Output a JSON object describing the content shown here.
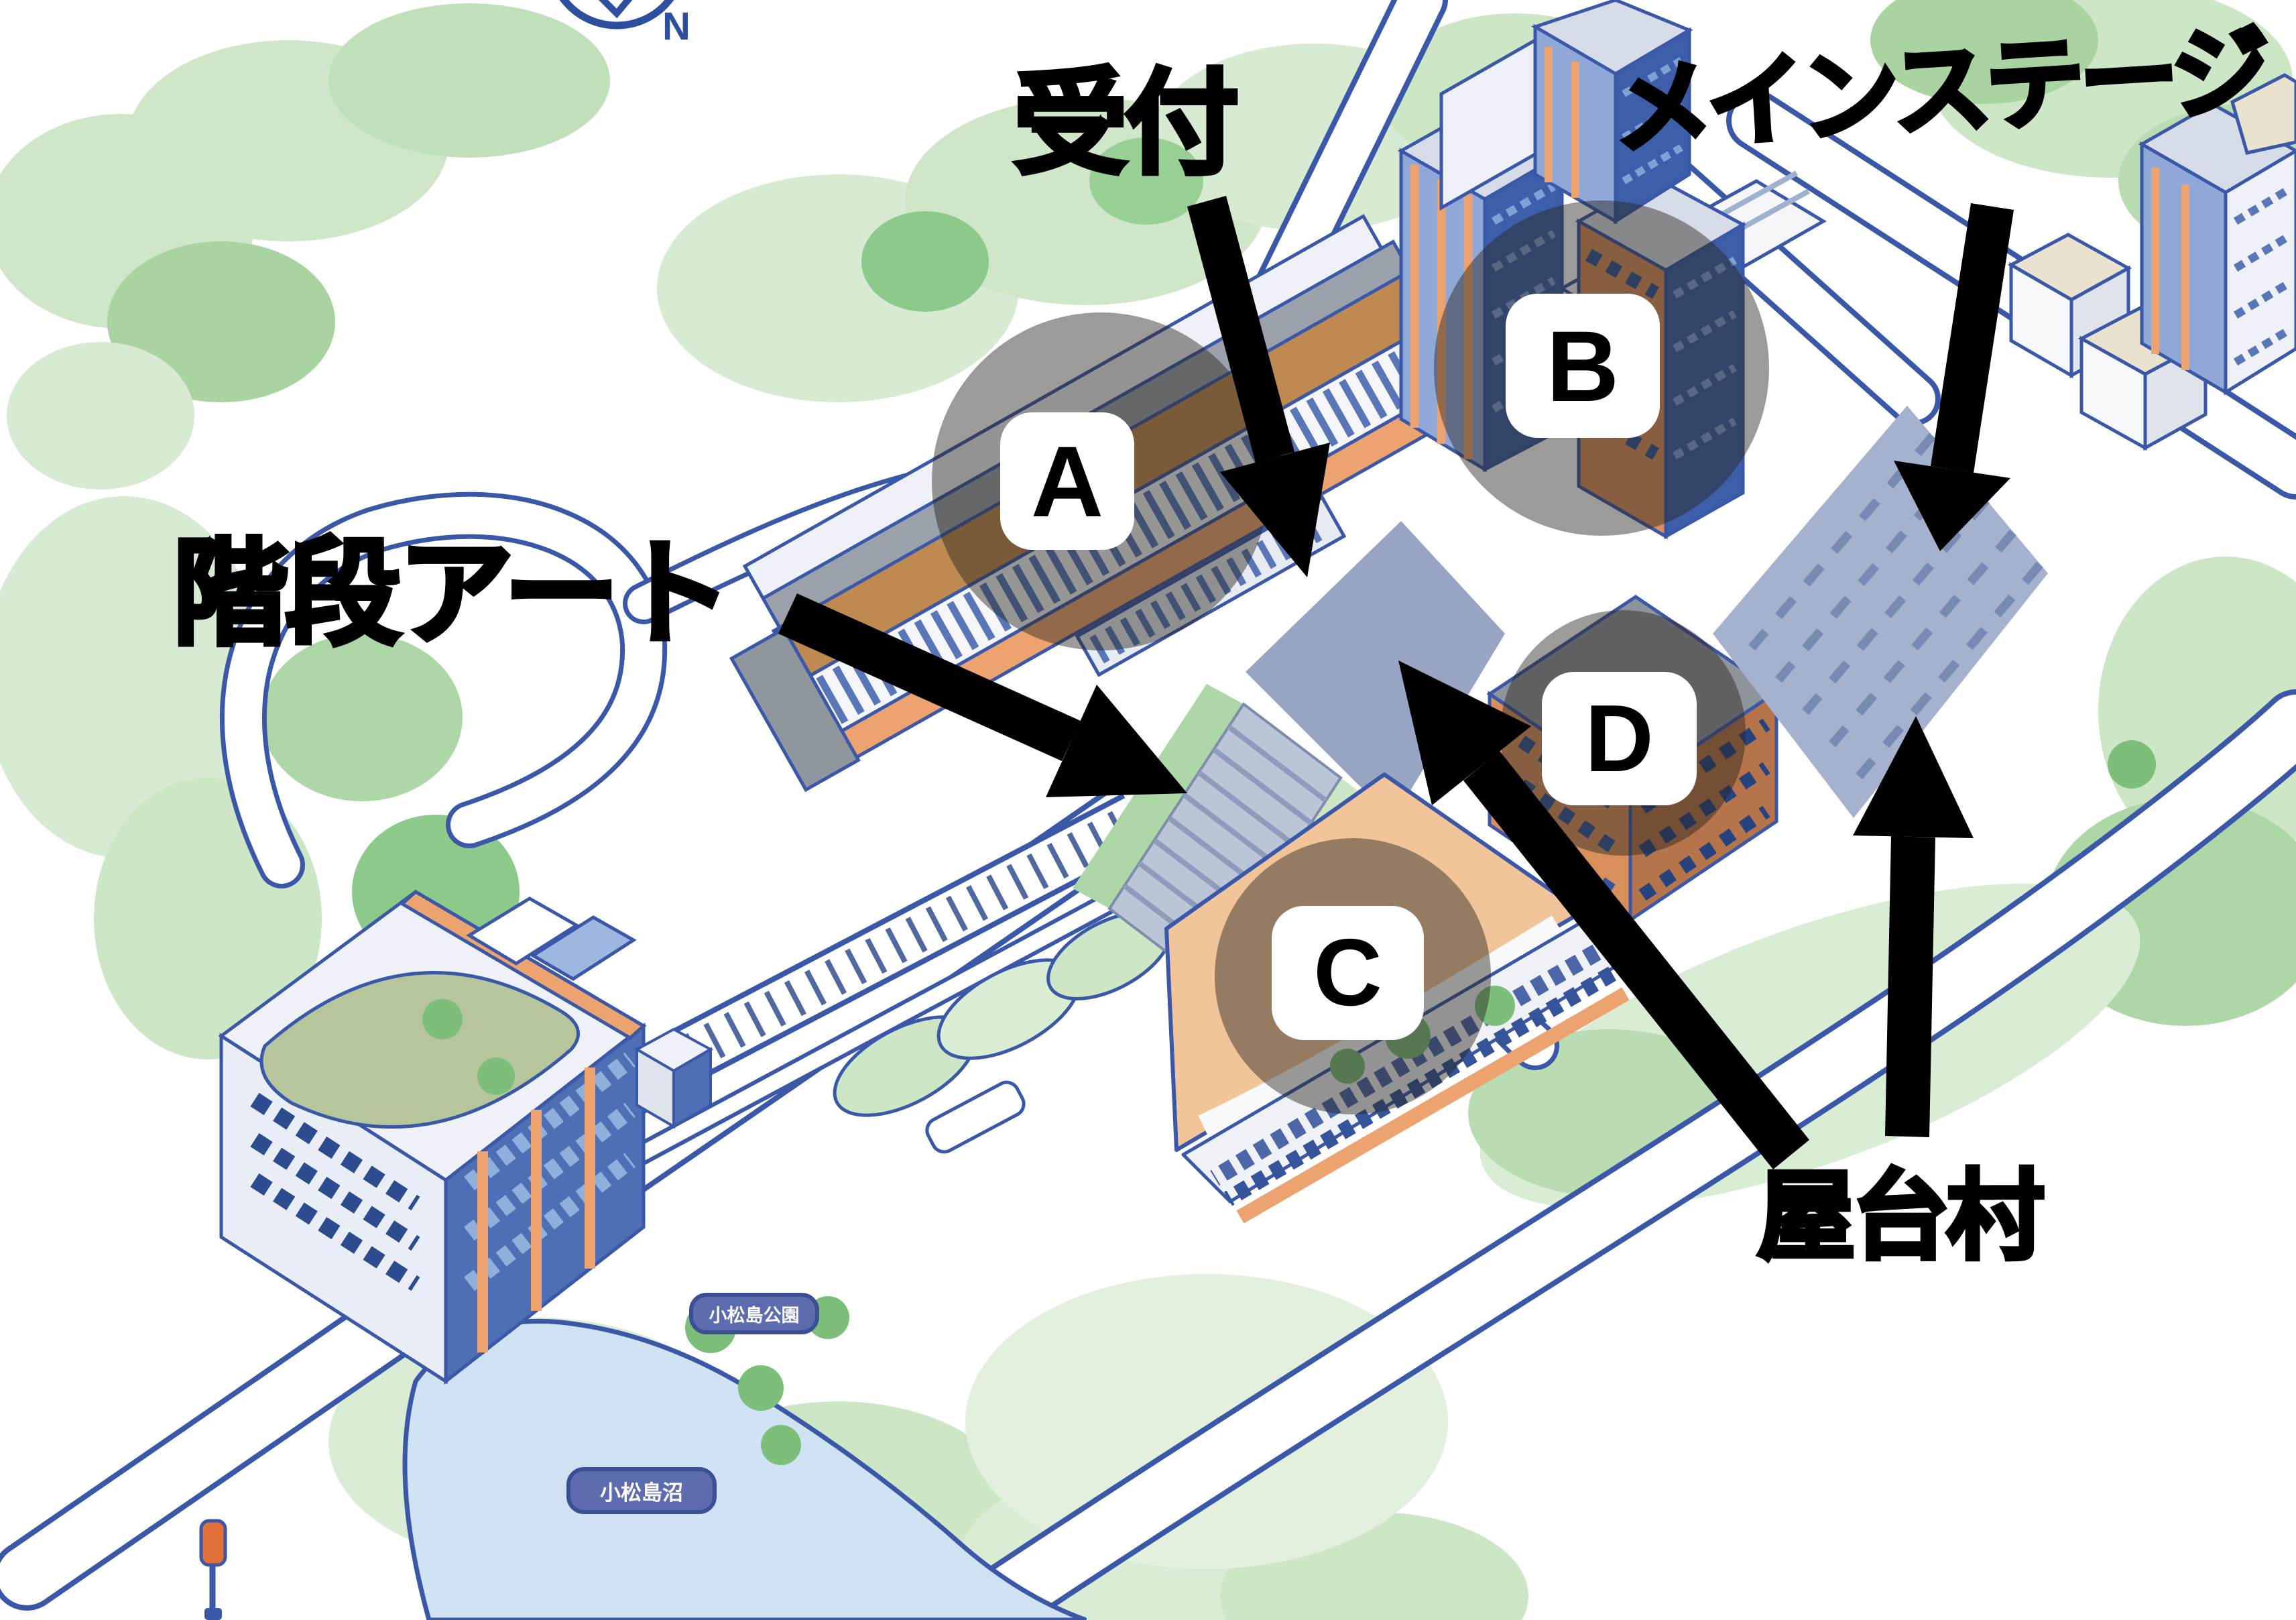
{
  "compass": {
    "label": "N"
  },
  "annotations": {
    "reception": {
      "label": "受付"
    },
    "main_stage": {
      "label": "メインステージ"
    },
    "stair_art": {
      "label": "階段アート"
    },
    "yatai_village": {
      "label": "屋台村"
    }
  },
  "markers": [
    {
      "label": "A"
    },
    {
      "label": "B"
    },
    {
      "label": "C"
    },
    {
      "label": "D"
    }
  ],
  "map_labels": {
    "park": "小松島公園",
    "pond": "小松島沼"
  },
  "colors": {
    "annotation_black": "#000000",
    "overlay_circle": "rgba(40,36,30,0.46)",
    "marker_chip_bg": "#ffffff",
    "map_outline_blue": "#3b57a7",
    "water": "#cfe3f4",
    "greenery_light": "#cfe7c8",
    "greenery_dark": "#82c47f",
    "plaza": "#97a5c3",
    "parking": "#a5b2cd",
    "building_orange": "#eca36f",
    "building_blue": "#4f6fb5",
    "compass_blue": "#2e4ea0",
    "pond_pill_bg": "#5d6cae"
  }
}
